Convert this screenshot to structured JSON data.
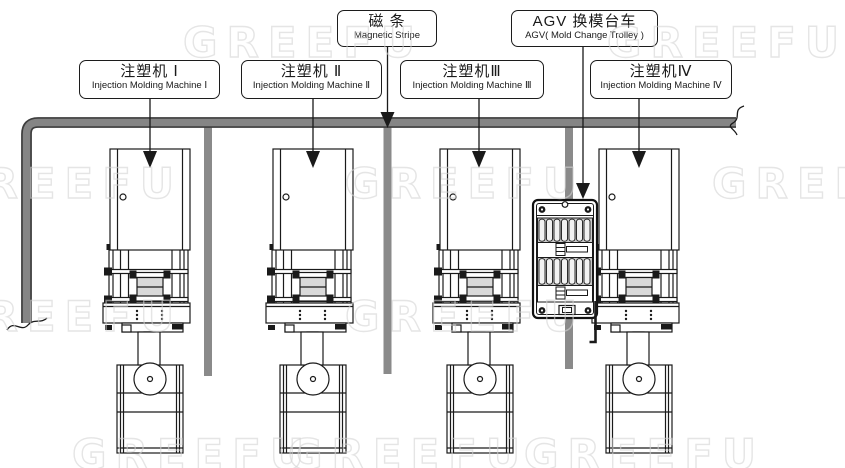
{
  "diagram": {
    "title_boxes": {
      "magnetic_stripe": {
        "zh": "磁 条",
        "en": "Magnetic Stripe"
      },
      "agv": {
        "zh": "AGV 换模台车",
        "en": "AGV( Mold Change Trolley )"
      }
    },
    "machine_boxes": [
      {
        "zh": "注塑机 Ⅰ",
        "en": "Injection Molding Machine Ⅰ"
      },
      {
        "zh": "注塑机 Ⅱ",
        "en": "Injection Molding Machine Ⅱ"
      },
      {
        "zh": "注塑机Ⅲ",
        "en": "Injection Molding Machine Ⅲ"
      },
      {
        "zh": "注塑机Ⅳ",
        "en": "Injection Molding Machine Ⅳ"
      }
    ],
    "watermark": "GREEFU",
    "colors": {
      "line": "#1a1a1a",
      "track_fill": "#858585",
      "track_edge": "#3d3d3d",
      "branch": "#8a8a8a",
      "mold_fill": "#d9d9d9",
      "watermark": "#d4d4d4"
    }
  }
}
